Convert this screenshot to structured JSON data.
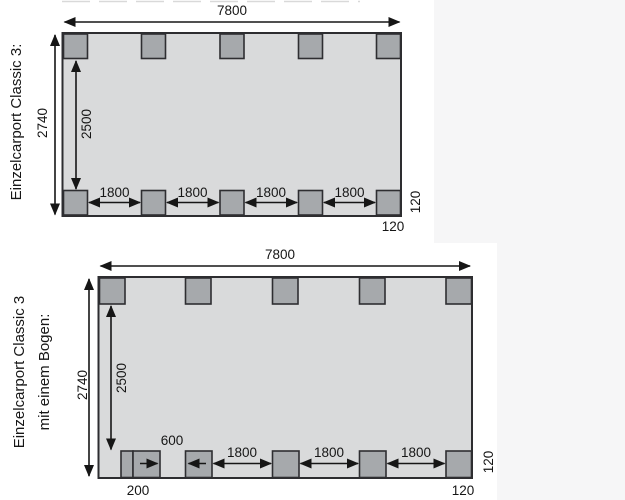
{
  "colors": {
    "floor_fill": "#d9dadb",
    "post_fill": "#a6a9ac",
    "outline": "#2d2d30",
    "dimension": "#161616",
    "page_tint": "#f6f6f7"
  },
  "top_diagram": {
    "title": "Einzelcarport Classic 3:",
    "width_dim": "7800",
    "depth_dim": "2740",
    "inner_depth_dim": "2500",
    "spacing_dims": [
      "1800",
      "1800",
      "1800",
      "1800"
    ],
    "side_post_dim": "120",
    "corner_post_dim": "120"
  },
  "bottom_diagram": {
    "title_line1": "Einzelcarport Classic 3",
    "title_line2": "mit einem Bogen:",
    "width_dim": "7800",
    "depth_dim": "2740",
    "inner_depth_dim": "2500",
    "arch_gap_dim": "600",
    "spacing_dims": [
      "1800",
      "1800",
      "1800"
    ],
    "arch_post_dim": "200",
    "side_post_dim": "120",
    "corner_post_dim": "120"
  }
}
